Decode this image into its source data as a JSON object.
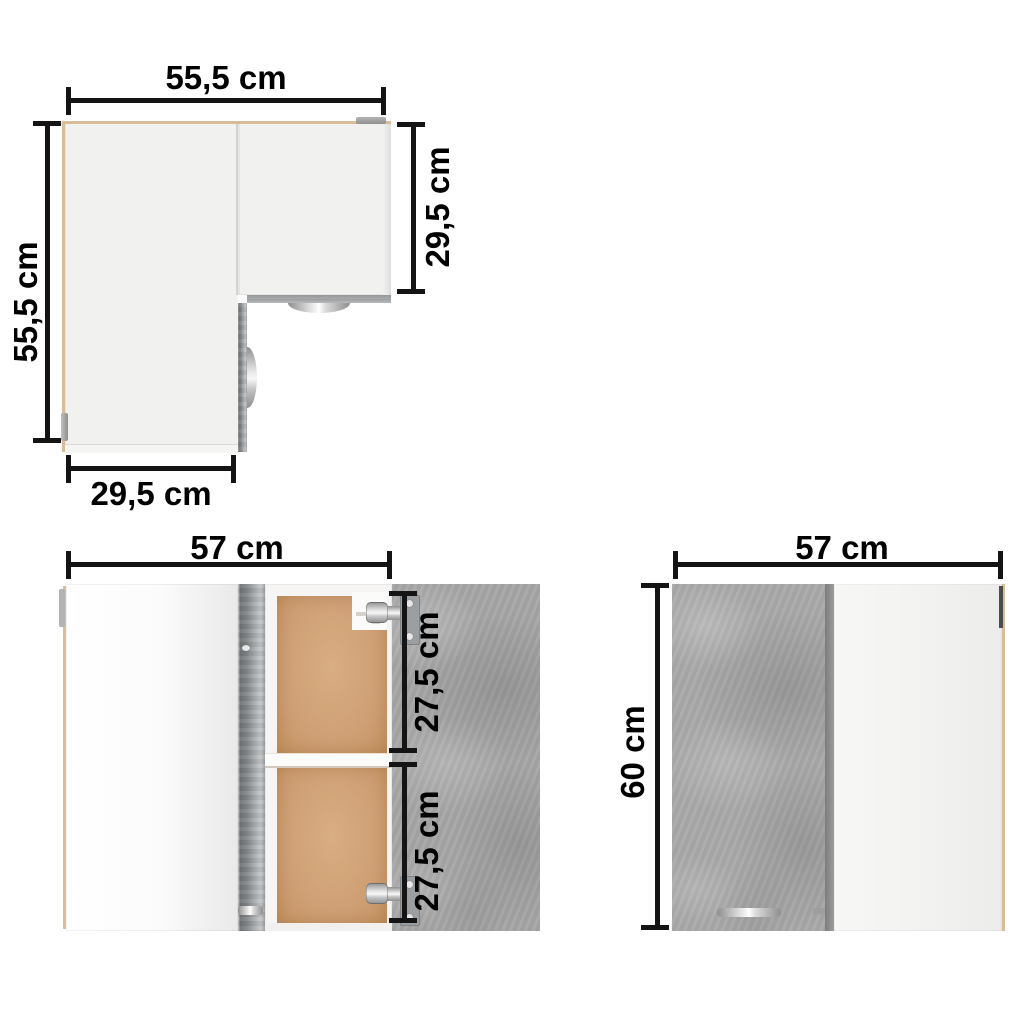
{
  "top_view": {
    "width_label": "55,5 cm",
    "depth_label": "55,5 cm",
    "right_depth_label": "29,5 cm",
    "bottom_width_label": "29,5 cm"
  },
  "front_open_view": {
    "width_label": "57 cm",
    "upper_shelf_label": "27,5 cm",
    "lower_shelf_label": "27,5 cm"
  },
  "front_closed_view": {
    "width_label": "57 cm",
    "height_label": "60 cm"
  },
  "colors": {
    "dimension_line": "#141414",
    "cabinet_white": "#f2f2f1",
    "concrete_gray": "#a6a6a6",
    "edge_tan": "#d9bd9b",
    "back_panel_tan": "#cf9e72",
    "metal_silver": "#c8c8c8"
  }
}
